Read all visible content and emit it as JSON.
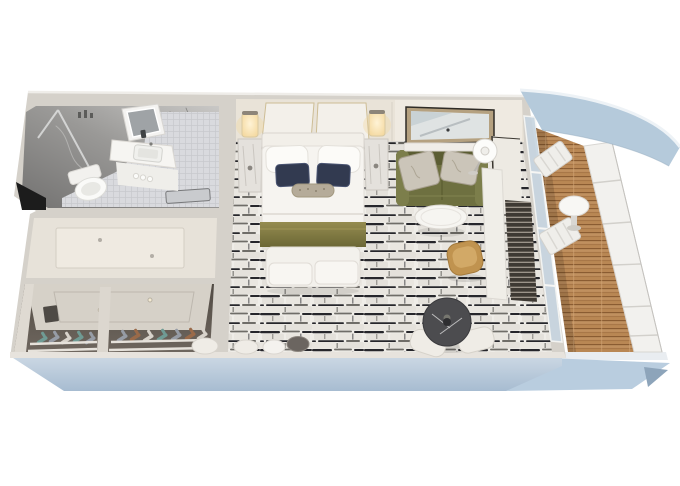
{
  "scene": {
    "description": "3D isometric cutaway floor plan render of a cruise ship balcony stateroom",
    "view": "top-down dollhouse cutaway, ship hull band below, private balcony at right",
    "rooms": [
      {
        "name": "bathroom",
        "position": "top-left",
        "features": [
          "gray marble walls",
          "LED vanity mirror",
          "white vanity sink cabinet",
          "toilet",
          "walk-in shower with glass panel",
          "mosaic tile floor",
          "bath mat",
          "dark doorway opening"
        ]
      },
      {
        "name": "entry-hall",
        "position": "mid-left",
        "features": [
          "cream floor",
          "recessed ceiling panel",
          "two downlights"
        ]
      },
      {
        "name": "walk-in-closet",
        "position": "bottom-left",
        "features": [
          "two shoe bays",
          "white shelf rails",
          "rows of high-heel shoes",
          "recessed ceiling panel with downlights",
          "white divider"
        ]
      },
      {
        "name": "bedroom",
        "position": "center",
        "features": [
          "queen bed with white bedding",
          "two white pillows",
          "two navy accent pillows",
          "patterned bolster",
          "olive bed runner",
          "upholstered foot bench",
          "marble nightstand towers",
          "two lit wall sconces",
          "cream headboard wall panels",
          "black-and-white flagstone pattern carpet",
          "round poufs"
        ]
      },
      {
        "name": "sitting-area",
        "position": "top-right of bedroom",
        "features": [
          "olive green sofa",
          "two damask pillows",
          "gold framed wall mirror",
          "white wall ledge",
          "white drum floor lamp",
          "round white coffee table"
        ]
      },
      {
        "name": "work-area",
        "position": "right of bedroom",
        "features": [
          "white desk counter",
          "dark slatted panel",
          "camel swivel chair",
          "round dark marble table",
          "two cream chairs"
        ]
      },
      {
        "name": "balcony",
        "position": "right",
        "features": [
          "teak plank deck",
          "white paneled railing",
          "round white pedestal table",
          "two white folding chairs",
          "curved blue deck overhang",
          "sliding glass door"
        ]
      }
    ],
    "ship": {
      "hull": "light blue-gray band under the cabin",
      "balcony_underside": "lighter blue wedge extending right"
    }
  },
  "palette": {
    "background": "#ffffff",
    "hull": "#a7bcd1",
    "hullLight": "#ccd8e4",
    "hullWedge": "#b9cddf",
    "hullTip": "#8da4ba",
    "hullFascia": "#e9edf1",
    "wallOuter": "#d5d1ca",
    "wallEdge": "#efede9",
    "wallFace": "#e7e3dd",
    "backWall": "#e9e3d8",
    "backWallLight": "#efeae1",
    "marbleDark": "#737271",
    "marbleLight": "#c9c8c6",
    "marbleVein": "#4a4a48",
    "mosaic": "#d9dade",
    "mosaicLine": "#c6c8cc",
    "floorCream": "#e7e2d9",
    "panelCream": "#efeae1",
    "dotGray": "#b3aea6",
    "closetCeil": "#d6d1c8",
    "closetLine": "#bdb7ae",
    "closetDark": "#6e665e",
    "shelfWhite": "#e6e2db",
    "shoeTeal": "#6f9b94",
    "shoeGray": "#969ca6",
    "shoeBrown": "#9a6a49",
    "shoeCream": "#d8d3cb",
    "carpetBase": "#efede8",
    "carpetSlabA": "#e9e6e0",
    "carpetSlabB": "#e4e1db",
    "carpetDark": "#26262b",
    "carpetMid": "#6f6d68",
    "bedWhite": "#f6f4f0",
    "pillowWhite": "#fcfbf8",
    "navyPillow": "#323a50",
    "bolster": "#b5ab99",
    "bolsterDot": "#8d8370",
    "runnerA": "#958c50",
    "runnerB": "#6b6735",
    "bench": "#f3f1ec",
    "sofa": "#6e7040",
    "sofaDark": "#5b5d33",
    "sofaLight": "#7c7e4b",
    "pillowSilver": "#cbc5b9",
    "mirrorFrameGold": "#b5a180",
    "mirrorEdge": "#2e2b26",
    "mirrorGlass": "#dfe3e3",
    "lampWhite": "#fcfcfa",
    "tableWhite": "#f6f5f1",
    "camel": "#c0934f",
    "camelLight": "#d2a967",
    "darkTable": "#4c4c4f",
    "tableVein": "#dadada",
    "slatDark": "#3e3933",
    "slatLine": "#b9b1a4",
    "deskWhite": "#f0eee8",
    "wood": "#b98754",
    "woodDark": "#8a5c32",
    "woodLight": "#d3a877",
    "railing": "#f2f1ee",
    "railingLine": "#d2d0cb",
    "glass": "#c7d5e0",
    "glassFrame": "#f5f6f5",
    "canopy": "#b5cadb",
    "canopyEdge": "#edf2f6",
    "canopyInner": "#9cb3c5",
    "sconceCore": "#fff3d6",
    "sconceGlow": "#f3d69a",
    "sconceCap": "#8d8579"
  }
}
